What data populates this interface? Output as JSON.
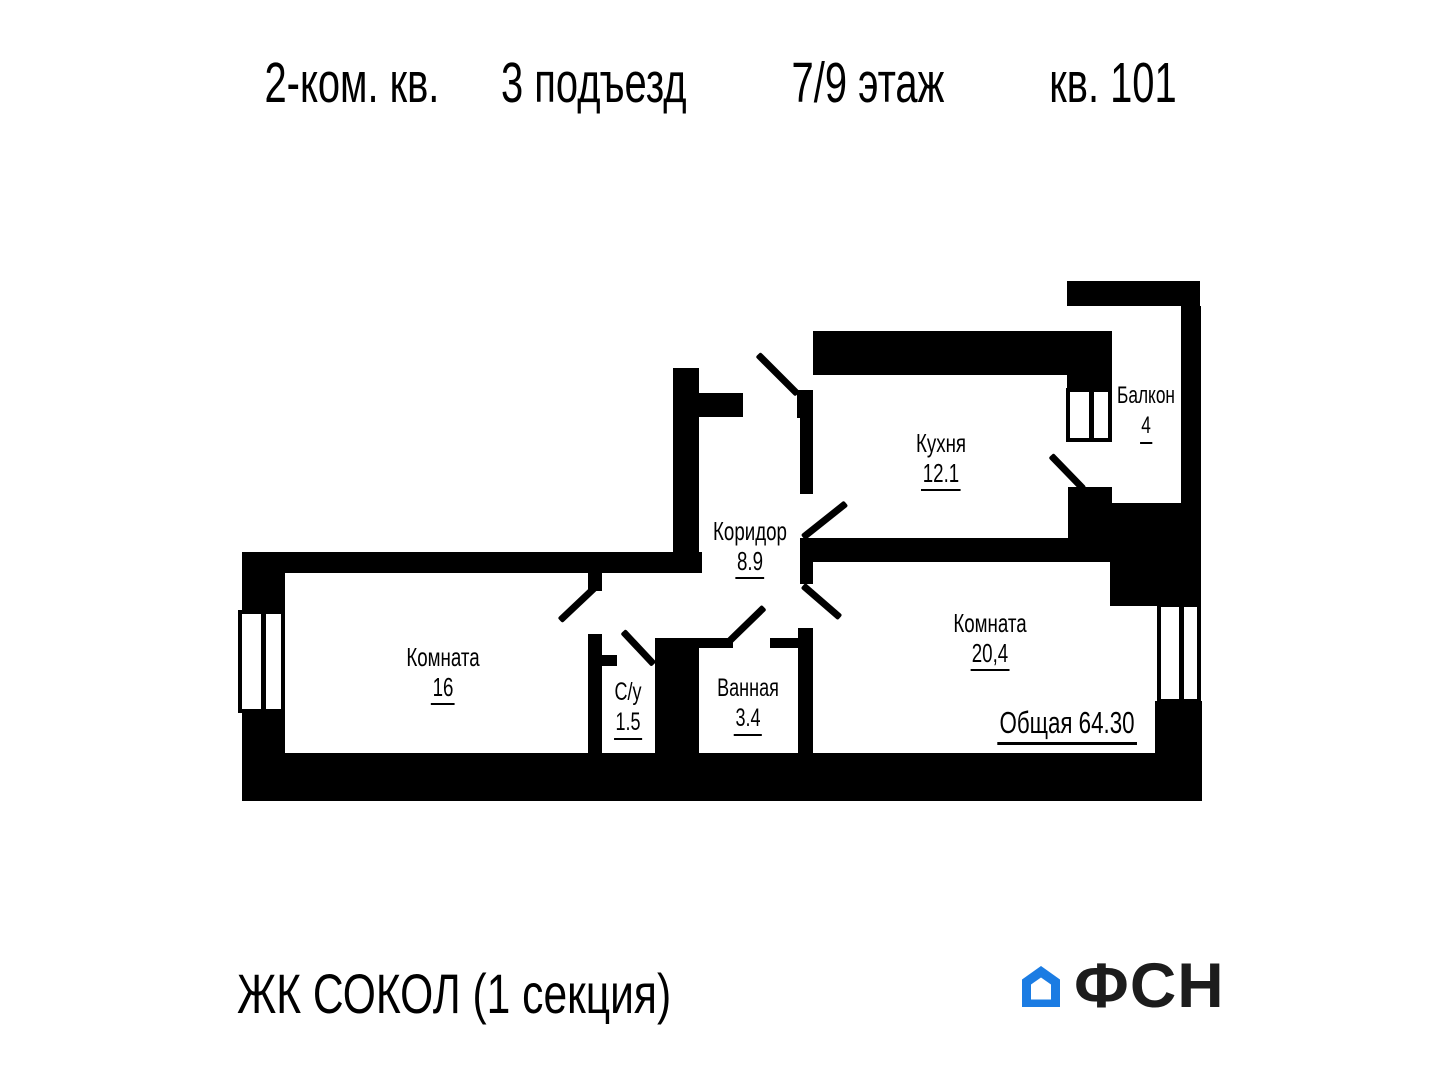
{
  "title": {
    "seg1": "2-ком. кв.",
    "seg2": "3 подъезд",
    "seg3": "7/9 этаж",
    "seg4": "кв. 101"
  },
  "rooms": {
    "balcony": {
      "name": "Балкон",
      "area": "4"
    },
    "kitchen": {
      "name": "Кухня",
      "area": "12.1"
    },
    "corridor": {
      "name": "Коридор",
      "area": "8.9"
    },
    "room1": {
      "name": "Комната",
      "area": "16"
    },
    "wc": {
      "name": "С/у",
      "area": "1.5"
    },
    "bath": {
      "name": "Ванная",
      "area": "3.4"
    },
    "room2": {
      "name": "Комната",
      "area": "20,4"
    }
  },
  "total": {
    "label": "Общая",
    "value": "64.30"
  },
  "footer": {
    "project": "ЖК СОКОЛ (1 секция)",
    "brand": "ФСН"
  },
  "colors": {
    "walls": "#000000",
    "text": "#000000",
    "brand_blue": "#1B7CE3"
  }
}
